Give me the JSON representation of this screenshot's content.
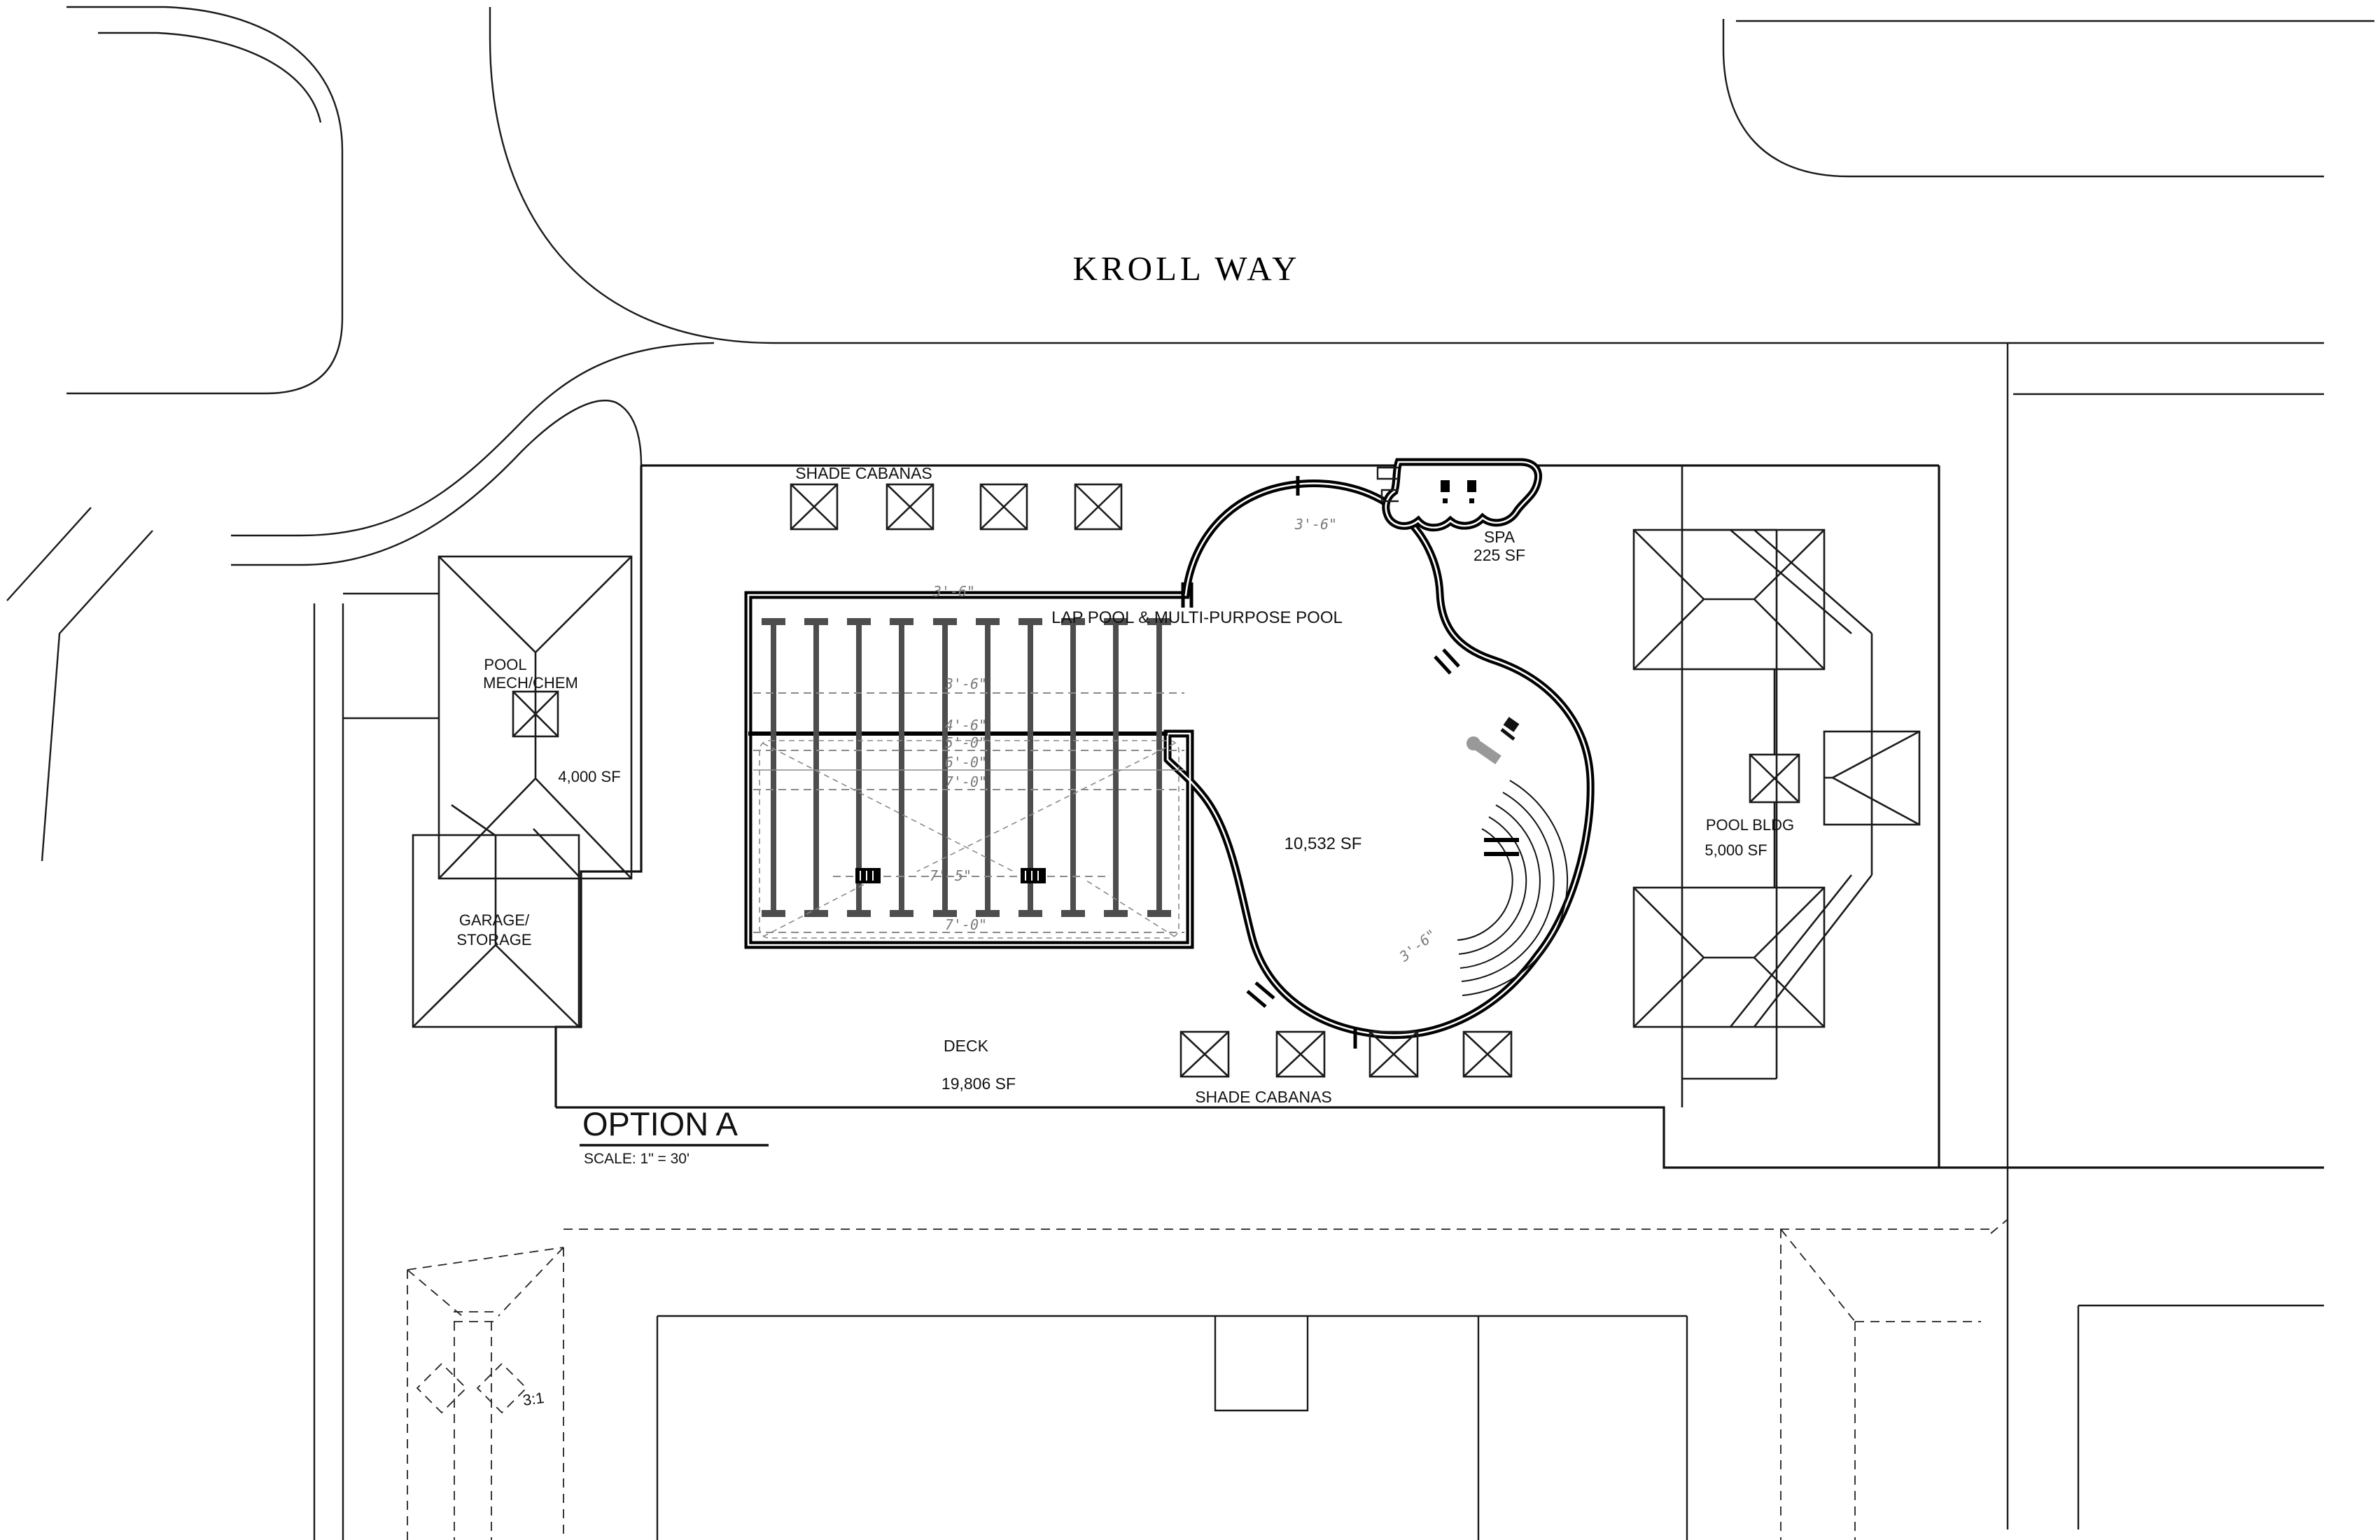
{
  "drawing": {
    "street": {
      "name": "KROLL WAY"
    },
    "plan": {
      "title": "OPTION A",
      "scale": "SCALE:  1\" = 30'"
    },
    "labels": {
      "shade_cabanas_top": "SHADE CABANAS",
      "shade_cabanas_bottom": "SHADE CABANAS",
      "lap_pool": "LAP POOL & MULTI-PURPOSE POOL",
      "pool_area": "10,532 SF",
      "spa_name": "SPA",
      "spa_area": "225 SF",
      "deck_name": "DECK",
      "deck_area": "19,806 SF",
      "pool_bldg_name": "POOL BLDG",
      "pool_bldg_area": "5,000 SF",
      "mech_line1": "POOL",
      "mech_line2": "MECH/CHEM",
      "mech_area": "4,000 SF",
      "garage_line1": "GARAGE/",
      "garage_line2": "STORAGE",
      "slope_ratio": "3:1"
    },
    "dimensions": {
      "lap_edge": "3'-6\"",
      "shallow": "3'-6\"",
      "d_4_6": "4'-6\"",
      "d_5_0": "5'-0\"",
      "d_6_0": "6'-0\"",
      "d_7_0": "7'-0\"",
      "deep_mid": "7'-5\"",
      "deep_end": "7'-0\"",
      "blob_edge": "3'-6\"",
      "steps_edge": "3'-6\""
    }
  }
}
